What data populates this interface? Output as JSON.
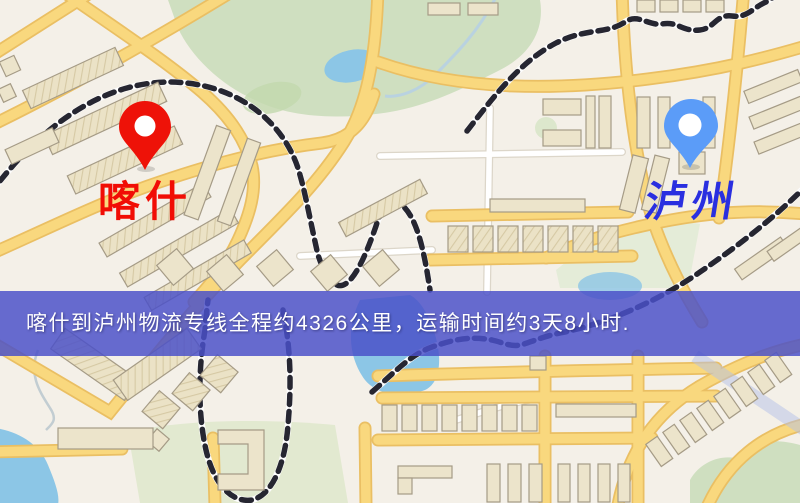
{
  "map": {
    "origin_marker": {
      "label": "喀什",
      "pin_color": "#ee1208",
      "pin_hole_color": "#ffffff",
      "label_color": "#f10d05"
    },
    "destination_marker": {
      "label": "泸州",
      "pin_color": "#5b9cf8",
      "pin_hole_color": "#ffffff",
      "label_color": "#2a2fe0"
    },
    "banner": {
      "text": "喀什到泸州物流专线全程约4326公里，运输时间约3天8小时.",
      "bg_color": "#4a50c8",
      "text_color": "#ffffff"
    },
    "palette": {
      "map_background": "#f4f0e8",
      "road_major": "#f9d87e",
      "road_casing": "#eabf63",
      "road_minor": "#ffffff",
      "railway_dark": "#262631",
      "park_green": "#cfdfc0",
      "field_green": "#e2e9d0",
      "water_blue": "#8cc6e6",
      "building_fill": "#ece4cb",
      "building_outline": "#a59b86"
    }
  },
  "route": {
    "origin": "喀什",
    "destination": "泸州",
    "distance_km": "4326",
    "duration": "3天8小时"
  }
}
